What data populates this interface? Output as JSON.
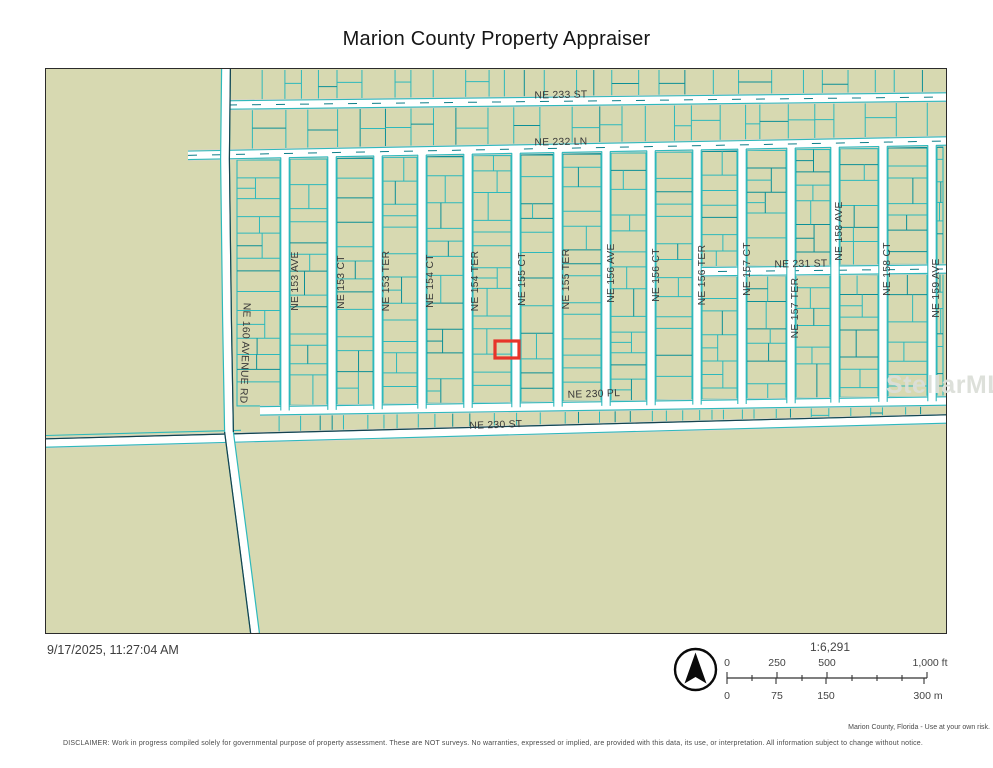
{
  "title": "Marion County Property Appraiser",
  "timestamp": "9/17/2025, 11:27:04 AM",
  "watermark": "StellarMLS",
  "attribution": "Marion County, Florida - Use at your own risk.",
  "disclaimer": "DISCLAIMER: Work in progress compiled solely for governmental purpose of property assessment. These are NOT surveys. No warranties, expressed or implied, are provided with this data, its use, or interpretation. All information subject to change without notice.",
  "scale": {
    "ratio": "1:6,291",
    "feet_labels": [
      "0",
      "250",
      "500",
      "1,000 ft"
    ],
    "meter_labels": [
      "0",
      "75",
      "150",
      "300 m"
    ]
  },
  "map": {
    "colors": {
      "background": "#d7d9b1",
      "parcel_line": "#2eb9bc",
      "parcel_line_dark": "#0d8f96",
      "road_fill": "#ffffff",
      "road_casing": "#d9d5ca",
      "road_dark_edge": "#16414e",
      "highlight": "#e7342a",
      "label_text": "#383838"
    },
    "selected_parcel": {
      "x": 449,
      "y": 272,
      "w": 24,
      "h": 17
    },
    "avenue_street": {
      "name": "NE 160 AVENUE RD",
      "label_x": 196,
      "label_y": 284,
      "angle": 92
    },
    "horizontal_streets": [
      {
        "name": "NE 233 ST",
        "label_x": 515,
        "label_y": 29,
        "angle": -1
      },
      {
        "name": "NE 232 LN",
        "label_x": 515,
        "label_y": 76,
        "angle": -1
      },
      {
        "name": "NE 231 ST",
        "label_x": 755,
        "label_y": 198,
        "angle": -1
      },
      {
        "name": "NE 230 PL",
        "label_x": 548,
        "label_y": 328,
        "angle": -2
      },
      {
        "name": "NE 230 ST",
        "label_x": 450,
        "label_y": 359,
        "angle": -2
      }
    ],
    "vertical_streets": [
      {
        "name": "NE 153 AVE",
        "road_x": 239,
        "label_x": 252,
        "label_y": 212
      },
      {
        "name": "NE 153 CT",
        "road_x": 286,
        "label_x": 298,
        "label_y": 213
      },
      {
        "name": "NE 153 TER",
        "road_x": 332,
        "label_x": 343,
        "label_y": 212
      },
      {
        "name": "NE 154 CT",
        "road_x": 376,
        "label_x": 387,
        "label_y": 212
      },
      {
        "name": "NE 154 TER",
        "road_x": 422,
        "label_x": 432,
        "label_y": 212
      },
      {
        "name": "NE 155 CT",
        "road_x": 470,
        "label_x": 479,
        "label_y": 210
      },
      {
        "name": "NE 155 TER",
        "road_x": 512,
        "label_x": 523,
        "label_y": 210
      },
      {
        "name": "NE 156 AVE",
        "road_x": 560,
        "label_x": 568,
        "label_y": 204
      },
      {
        "name": "NE 156 CT",
        "road_x": 605,
        "label_x": 613,
        "label_y": 206
      },
      {
        "name": "NE 156 TER",
        "road_x": 651,
        "label_x": 659,
        "label_y": 206
      },
      {
        "name": "NE 157 CT",
        "road_x": 696,
        "label_x": 704,
        "label_y": 200
      },
      {
        "name": "NE 157 TER",
        "road_x": 745,
        "label_x": 752,
        "label_y": 239
      },
      {
        "name": "NE 158 AVE",
        "road_x": 789,
        "label_x": 796,
        "label_y": 162
      },
      {
        "name": "NE 158 CT",
        "road_x": 837,
        "label_x": 844,
        "label_y": 200
      },
      {
        "name": "NE 159 AVE",
        "road_x": 886,
        "label_x": 893,
        "label_y": 219
      }
    ]
  }
}
